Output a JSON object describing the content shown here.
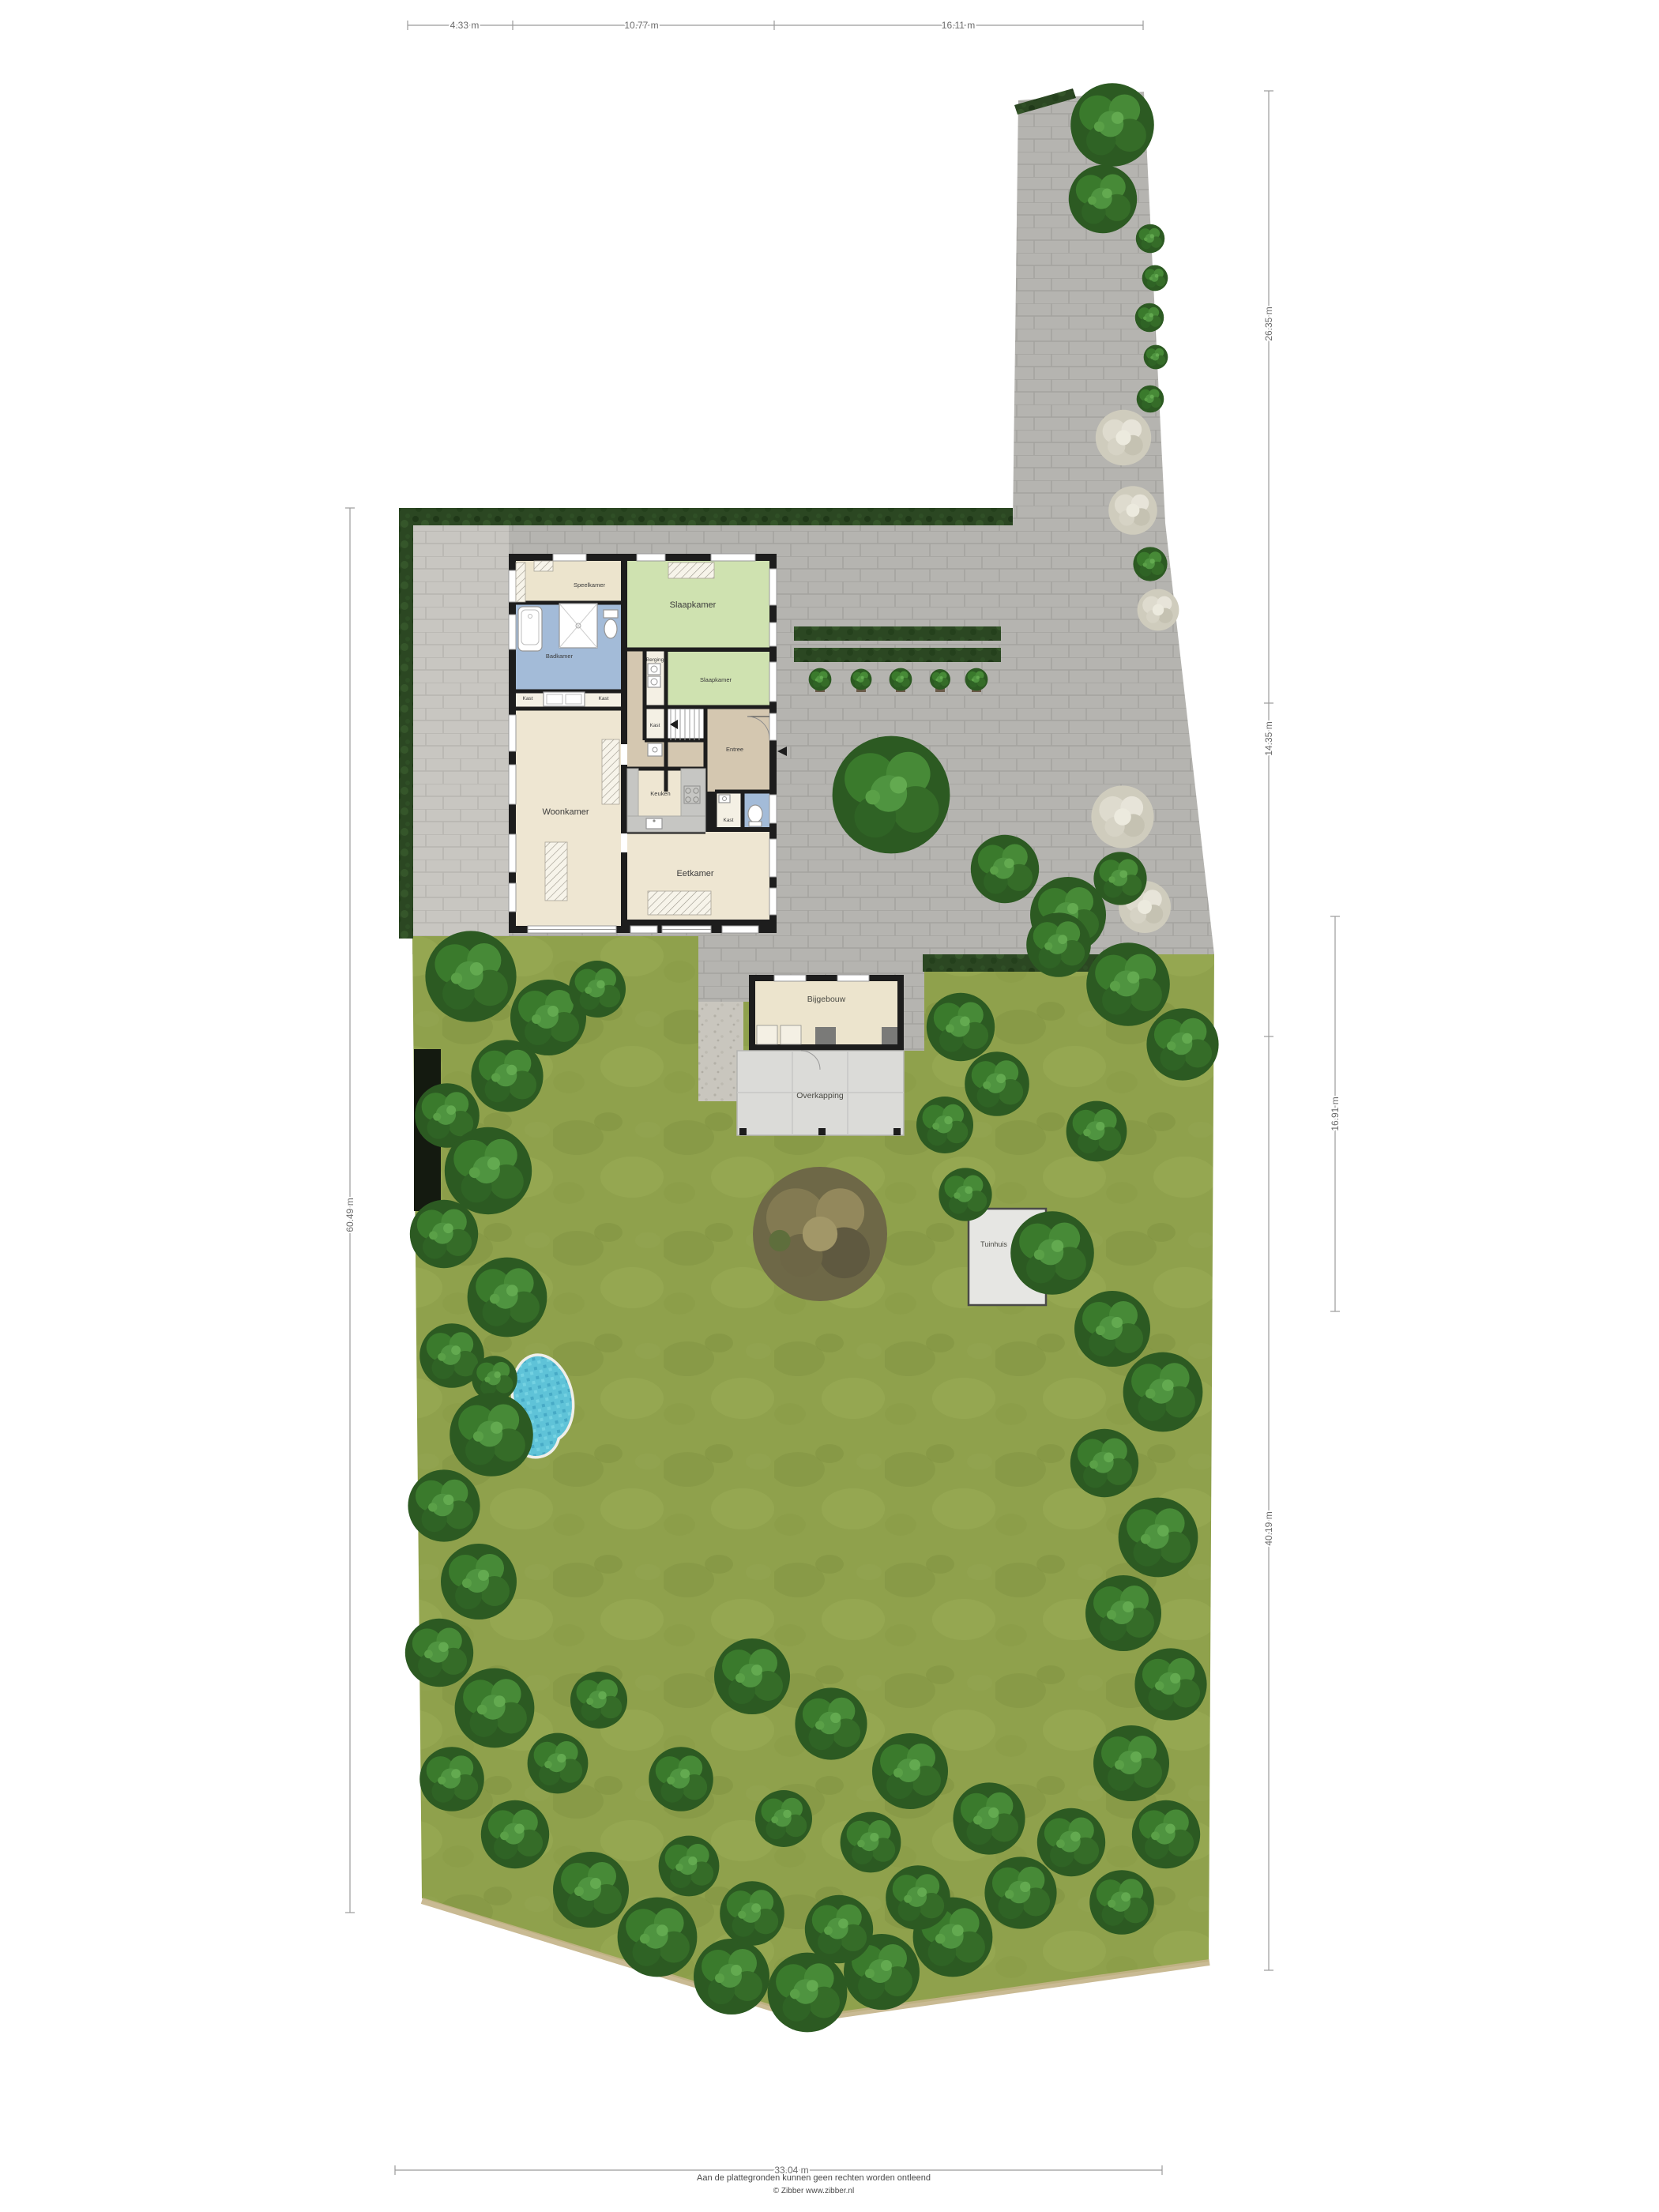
{
  "site": {
    "dims": {
      "t1": "4.33 m",
      "t2": "10.77 m",
      "t3": "16.11 m",
      "r1": "26.35 m",
      "r2": "14.35 m",
      "r3": "16.91 m",
      "r4": "40.19 m",
      "l1": "60.49 m",
      "b1": "33.04 m"
    },
    "rooms": {
      "speelkamer": "Speelkamer",
      "badkamer": "Badkamer",
      "slaapkamer": "Slaapkamer",
      "berging": "Berging",
      "kast": "Kast",
      "woonkamer": "Woonkamer",
      "keuken": "Keuken",
      "entree": "Entree",
      "eetkamer": "Eetkamer"
    },
    "outbuildings": {
      "bijgebouw": "Bijgebouw",
      "overkapping": "Overkapping",
      "tuinhuis": "Tuinhuis"
    },
    "footer": {
      "disclaimer": "Aan de plattegronden kunnen geen rechten worden ontleend",
      "credit": "© Zibber www.zibber.nl"
    },
    "palette": {
      "grass": "#8fa14c",
      "paving": "#b5b4b0",
      "paving_light": "#c8c6c1",
      "hedge": "#2b4722",
      "wall": "#1d1d1d",
      "bedroom": "#cfe2b0",
      "bathroom": "#a3bbd8",
      "floor": "#eee6d2",
      "hall": "#d4c7b0",
      "counter": "#c6c6c3",
      "canopy": "#dbdbd8",
      "pool": "#5fc3d8"
    }
  }
}
